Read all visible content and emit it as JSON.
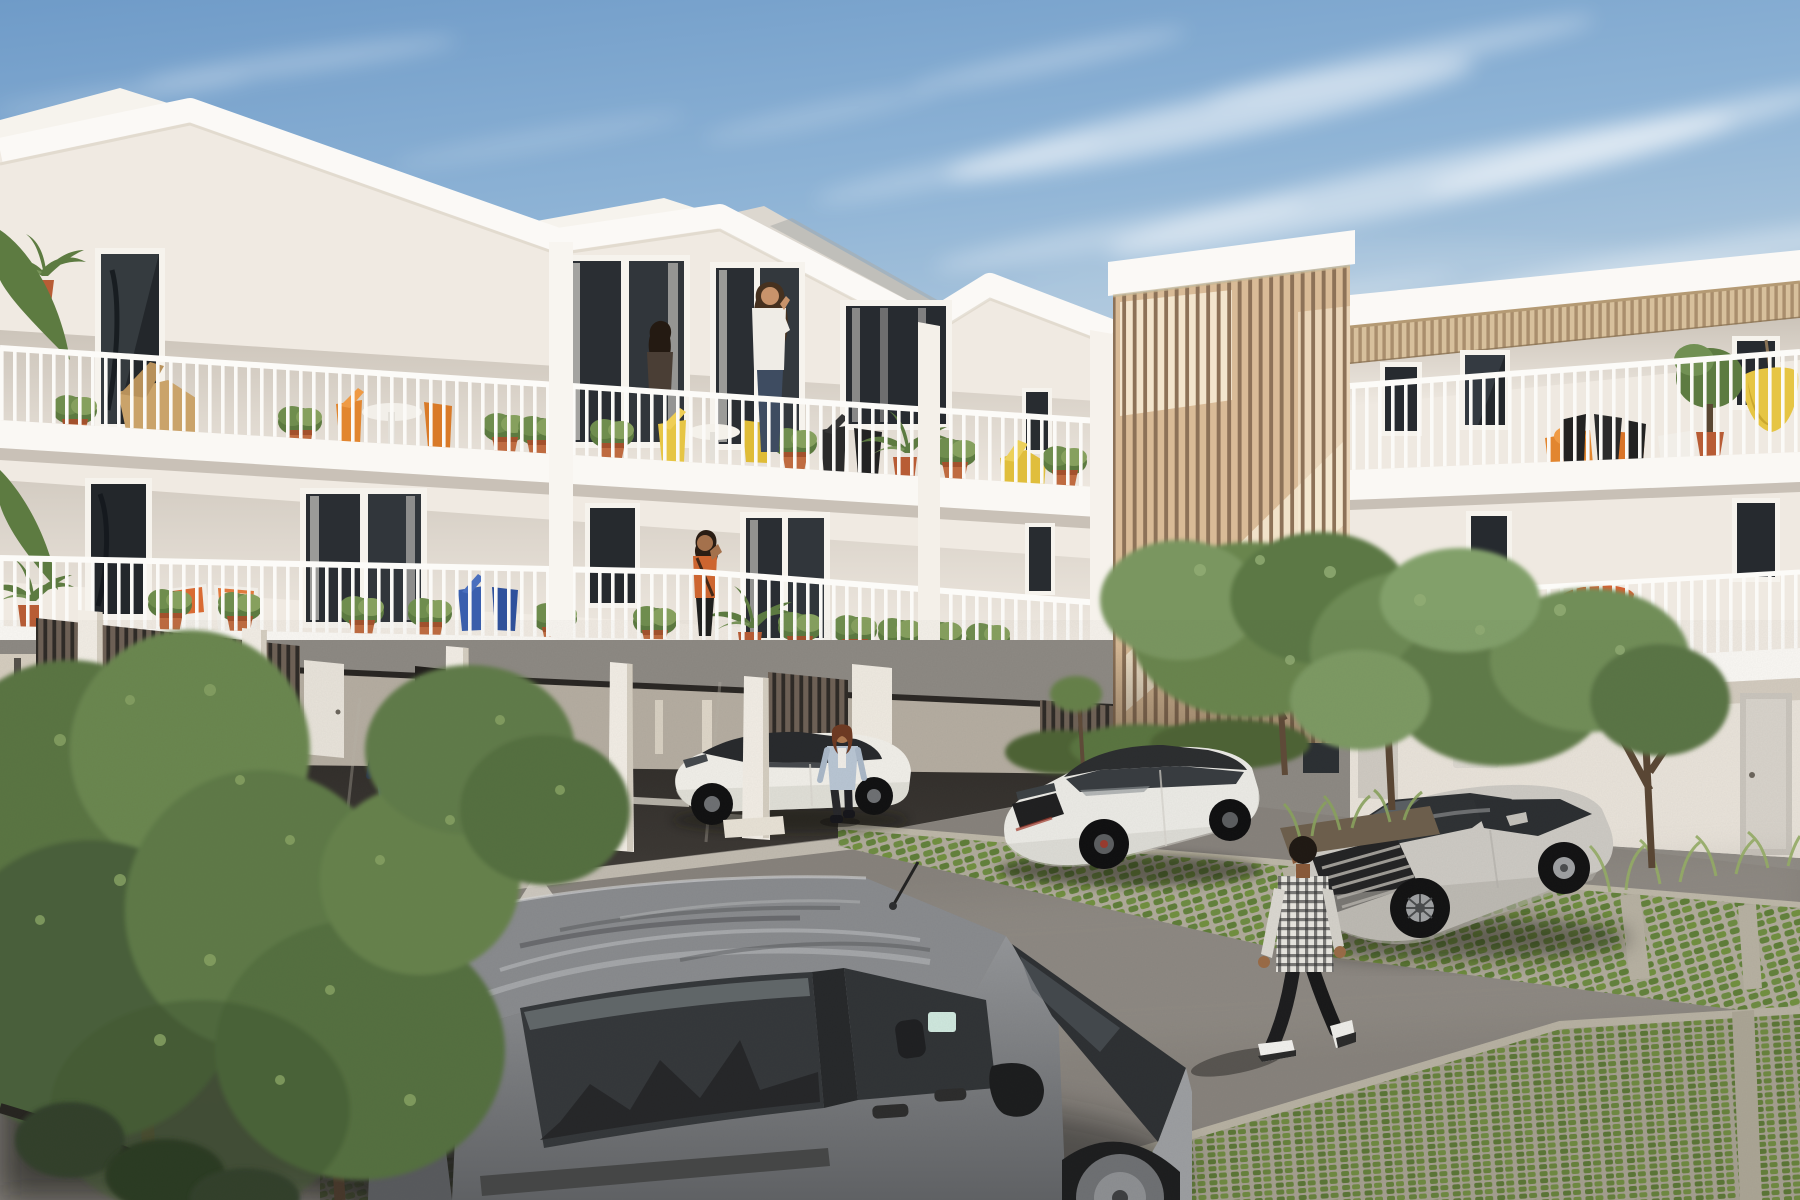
{
  "scene": {
    "label": "Sunlit 3D architectural rendering of a modern white apartment complex with courtyard parking",
    "setting_label": "residential courtyard, daytime, blue sky with wispy cirrus clouds",
    "width_px": 1800,
    "height_px": 1200
  },
  "palette": {
    "sky_top": "#6f9bc8",
    "sky_horizon": "#dcdcd2",
    "cloud": "#ffffff",
    "facade_white": "#f0eae2",
    "fascia_white": "#fbf9f6",
    "facade_recess": "#e7e0d6",
    "timber_light": "#d9bb97",
    "timber_gap": "#8d7258",
    "pergola_wood": "#d7c09c",
    "carport_wood": "#6e6156",
    "carport_shadow": "#332f2b",
    "asphalt": "#8d8983",
    "asphalt_shadow": "#2e2b28",
    "paver_concrete": "#b0ab9b",
    "paver_grass": "#66853d",
    "terracotta": "#bf6b40",
    "accent_orange": "#e2862f",
    "accent_yellow": "#e6c544",
    "accent_blue": "#3a5fae",
    "foliage": "#6b8750",
    "car_white": "#eceae5",
    "car_silver": "#cdcac4",
    "van_grey": "#898b8e"
  },
  "buildings": {
    "main_block": {
      "label": "three-storey white apartment building with three gabled roof sections, stacked balconies and open carport underneath",
      "gables_visible": 3,
      "floors_visible": 3
    },
    "stair_tower": {
      "label": "vertical timber-slat staircase tower with sunlight shining through the battens"
    },
    "right_wing": {
      "label": "two-storey white wing with rooftop timber pergola, balconies and ground-floor doors"
    }
  },
  "balconies": {
    "railing_label": "white vertical-bar railings",
    "plants_label": "terracotta pots with green plants and potted palms",
    "furniture": [
      {
        "label": "wooden lounge chair"
      },
      {
        "label": "white round bistro table with orange chairs"
      },
      {
        "label": "yellow bistro set"
      },
      {
        "label": "black wire chairs"
      },
      {
        "label": "chairs with orange-and-white cushions"
      },
      {
        "label": "blue folding chairs"
      },
      {
        "label": "yellow hanging chair"
      },
      {
        "label": "orange parasol"
      },
      {
        "label": "yellow loungers"
      }
    ]
  },
  "people": [
    {
      "label": "woman in white sweater talking on phone, upper balcony"
    },
    {
      "label": "dark-haired woman at upper balcony door"
    },
    {
      "label": "woman in orange top on middle balcony"
    },
    {
      "label": "man in navy shirt walking through the carport"
    },
    {
      "label": "woman in light denim jacket standing beside white sedan"
    },
    {
      "label": "man in black-and-white plaid shirt walking across the courtyard"
    }
  ],
  "vehicles": [
    {
      "label": "white compact car parked inside the carport",
      "color_label": "white"
    },
    {
      "label": "white electric sedan parked at the carport edge",
      "color_label": "white"
    },
    {
      "label": "white hatchback parked on grass pavers by the timber tower",
      "color_label": "white"
    },
    {
      "label": "silver sedan parked on grass pavers by the right wing",
      "color_label": "silver"
    },
    {
      "label": "grey panel van in the foreground with tree reflections on the roof",
      "color_label": "grey"
    }
  ],
  "ground": {
    "surface_label": "asphalt courtyard with sun and tree shadows",
    "markings": [
      {
        "label": "white directional arrow"
      },
      {
        "label": "white dashed parking lines"
      },
      {
        "label": "white circle marking"
      }
    ],
    "pavers_label": "grass-grid permeable parking pavers with concrete divider strips",
    "vegetation_label": "leafy courtyard trees, shrubs and ornamental grasses"
  }
}
